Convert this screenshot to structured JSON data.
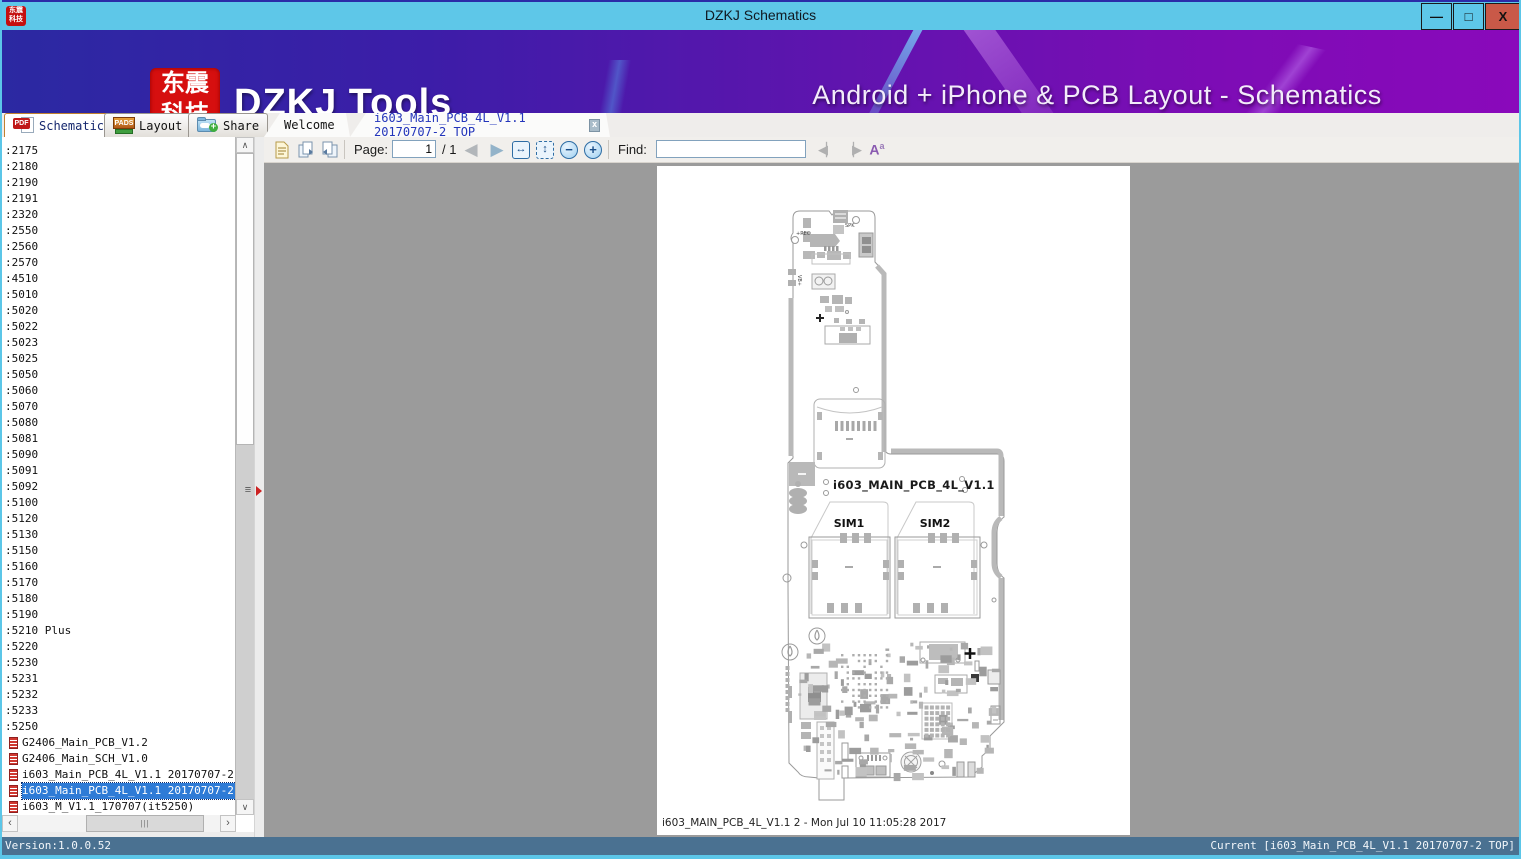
{
  "window": {
    "title": "DZKJ Schematics"
  },
  "icons": {
    "minimize": "—",
    "maximize": "□",
    "close": "X",
    "scroll_up": "∧",
    "scroll_down": "∨",
    "scroll_left": "‹",
    "scroll_right": "›",
    "grip": "≡",
    "hgrip": "|||",
    "nav_prev": "◀",
    "nav_next": "▶",
    "fit_width": "↔",
    "fit_page": "↕",
    "zoom_out": "−",
    "zoom_in": "+",
    "find_prev": "◀▏",
    "find_next": "▕▶",
    "case_a": "A",
    "case_sup": "a",
    "pdf_text": "PDF",
    "pads_text": "PADS",
    "plus": "+",
    "doc_new": "🗎",
    "doc_copy1": "🗗",
    "doc_copy2": "🗗"
  },
  "banner": {
    "logo_line1": "东震",
    "logo_line2": "科技",
    "brand": "DZKJ Tools",
    "tagline": "Android + iPhone & PCB Layout - Schematics"
  },
  "tabs": {
    "schematic": "Schematic",
    "layout": "Layout",
    "share": "Share",
    "welcome": "Welcome",
    "document": "i603_Main_PCB_4L_V1.1 20170707-2 TOP",
    "close": "x"
  },
  "toolbar": {
    "page_label": "Page:",
    "page_value": "1",
    "page_total": "/ 1",
    "find_label": "Find:",
    "find_value": ""
  },
  "sidebar": {
    "items": [
      {
        "label": ":2175"
      },
      {
        "label": ":2180"
      },
      {
        "label": ":2190"
      },
      {
        "label": ":2191"
      },
      {
        "label": ":2320"
      },
      {
        "label": ":2550"
      },
      {
        "label": ":2560"
      },
      {
        "label": ":2570"
      },
      {
        "label": ":4510"
      },
      {
        "label": ":5010"
      },
      {
        "label": ":5020"
      },
      {
        "label": ":5022"
      },
      {
        "label": ":5023"
      },
      {
        "label": ":5025"
      },
      {
        "label": ":5050"
      },
      {
        "label": ":5060"
      },
      {
        "label": ":5070"
      },
      {
        "label": ":5080"
      },
      {
        "label": ":5081"
      },
      {
        "label": ":5090"
      },
      {
        "label": ":5091"
      },
      {
        "label": ":5092"
      },
      {
        "label": ":5100"
      },
      {
        "label": ":5120"
      },
      {
        "label": ":5130"
      },
      {
        "label": ":5150"
      },
      {
        "label": ":5160"
      },
      {
        "label": ":5170"
      },
      {
        "label": ":5180"
      },
      {
        "label": ":5190"
      },
      {
        "label": ":5210 Plus"
      },
      {
        "label": ":5220"
      },
      {
        "label": ":5230"
      },
      {
        "label": ":5231"
      },
      {
        "label": ":5232"
      },
      {
        "label": ":5233"
      },
      {
        "label": ":5250"
      },
      {
        "label": "G2406_Main_PCB_V1.2",
        "icon": true
      },
      {
        "label": "G2406_Main_SCH_V1.0",
        "icon": true
      },
      {
        "label": "i603_Main_PCB_4L_V1.1 20170707-2 bot",
        "icon": true
      },
      {
        "label": "i603_Main_PCB_4L_V1.1 20170707-2 TOP",
        "icon": true,
        "selected": true
      },
      {
        "label": "i603_M_V1.1_170707(it5250)",
        "icon": true
      }
    ]
  },
  "pcb": {
    "board_title": "i603_MAIN_PCB_4L_V1.1",
    "sim1": "SIM1",
    "sim2": "SIM2",
    "caption": "i603_MAIN_PCB_4L_V1.1 2 - Mon Jul 10 11:05:28 2017",
    "label_rec": "+REC",
    "label_spk": "SPK",
    "label_vb": "VB+"
  },
  "status": {
    "version": "Version:1.0.0.52",
    "current": "Current [i603_Main_PCB_4L_V1.1 20170707-2 TOP]"
  },
  "colors": {
    "titlebar": "#5ec7e8",
    "close_button": "#c95948",
    "banner_left": "#2b29a2",
    "banner_right": "#8a09bb",
    "logo_red": "#d60f0f",
    "selection_blue": "#2e7bd6",
    "statusbar": "#4a7191",
    "viewer_gray": "#9b9b9b"
  }
}
